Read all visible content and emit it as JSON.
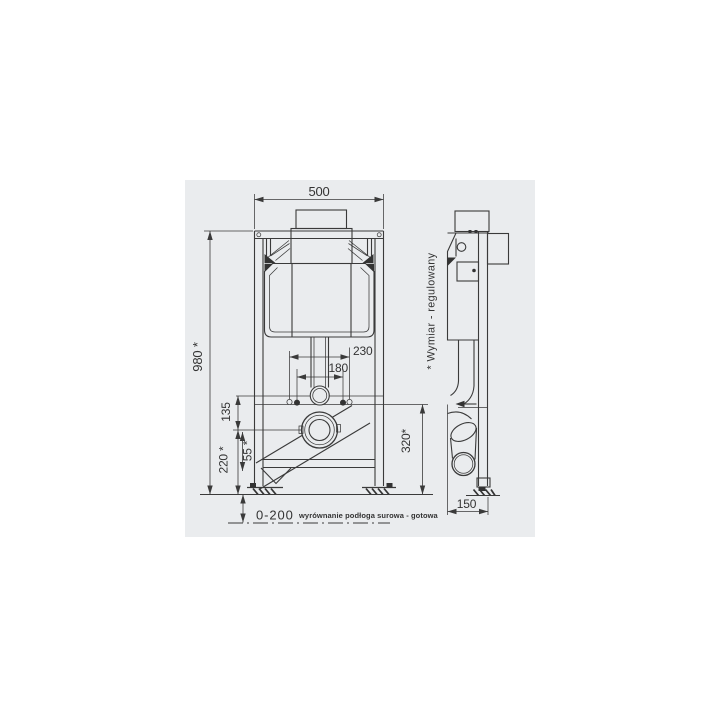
{
  "drawing": {
    "title": "WC installation frame technical drawing",
    "colors": {
      "page_background": "#ffffff",
      "drawing_background": "#eaecee",
      "line": "#3a3a3a",
      "text": "#333333"
    },
    "front_view": {
      "dims": {
        "width": "500",
        "height": "980 *",
        "rod_outer": "230",
        "rod_inner": "180",
        "flush_offset": "135",
        "outlet_height": "220 *",
        "offset_small": "55 *",
        "lower_height": "320*",
        "floor_leveling": "0-200"
      },
      "notes": {
        "floor": "wyrównanie podłoga surowa - gotowa",
        "adjustable": "* Wymiar - regulowany"
      }
    },
    "side_view": {
      "dims": {
        "depth": "150"
      }
    }
  }
}
